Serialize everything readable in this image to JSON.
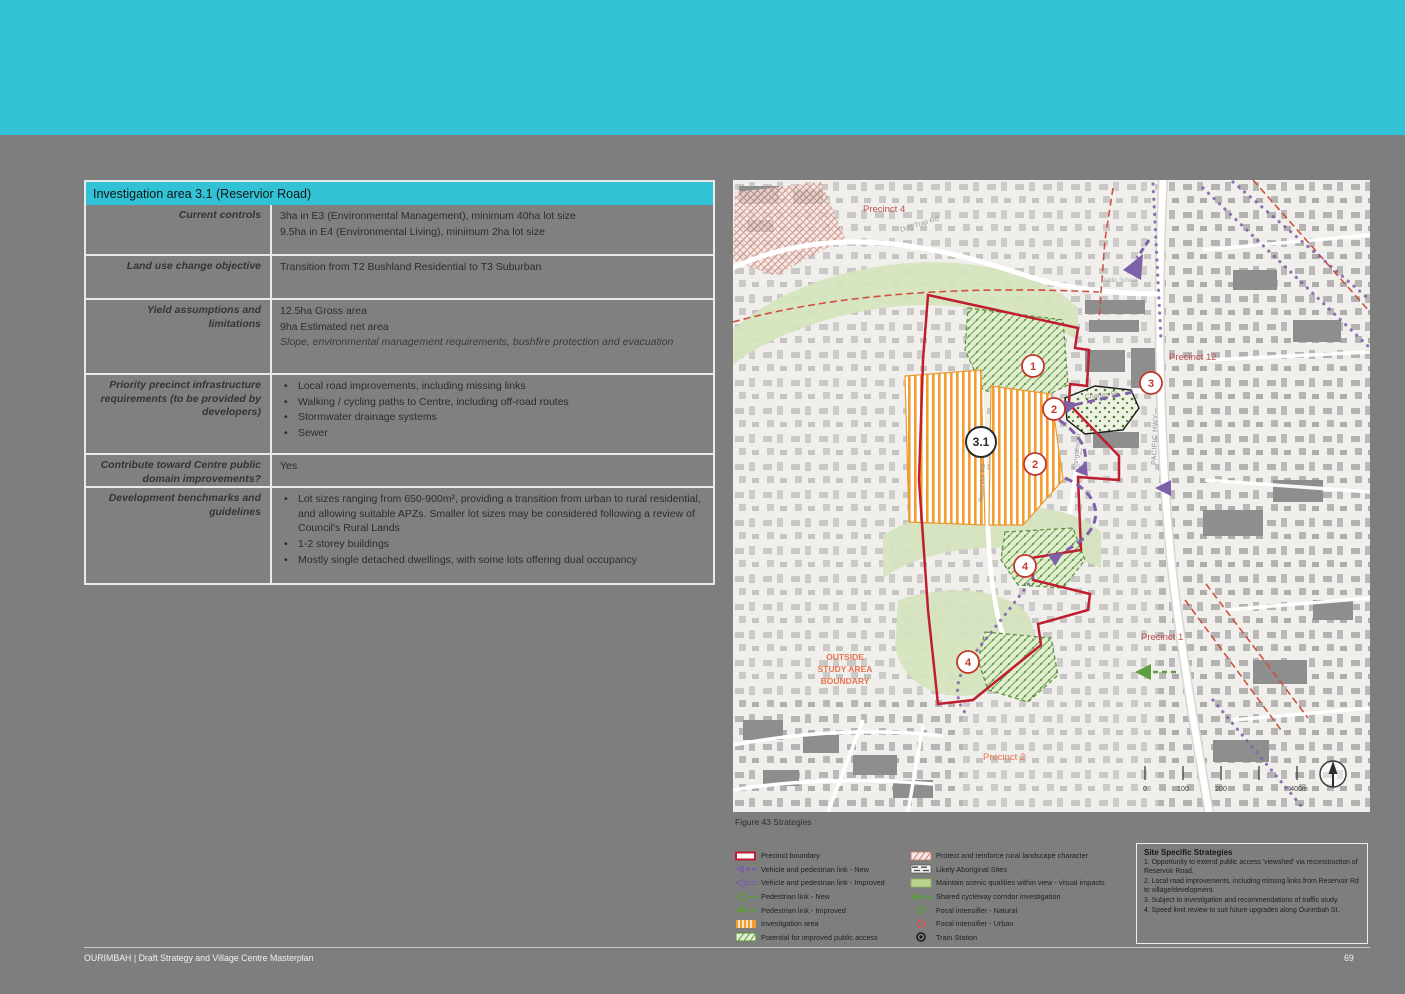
{
  "colors": {
    "banner": "#31c3d5",
    "page_bg": "#7e7e7e",
    "precinct_red": "#bf1e2e",
    "link_purple": "#7d60a8",
    "link_green": "#5f9e3e",
    "investigation_orange": "#f39c2f",
    "precinct_label_red": "#c0504d",
    "outside_orange": "#e8744f"
  },
  "table": {
    "title": "Investigation area 3.1 (Reservior Road)",
    "rows": [
      {
        "label": "Current controls",
        "lines": [
          "3ha in E3 (Environmental Management), minimum 40ha lot size",
          "9.5ha in E4 (Environmental Living), minimum 2ha lot size"
        ]
      },
      {
        "label": "Land use change objective",
        "lines": [
          "Transition from T2 Bushland Residential to T3 Suburban"
        ]
      },
      {
        "label": "Yield assumptions and limitations",
        "lines": [
          "12.5ha Gross area",
          "9ha Estimated net area"
        ],
        "note": "Slope, environmental management requirements, bushfire protection and evacuation"
      },
      {
        "label": "Priority precinct infrastructure requirements (to be provided by developers)",
        "bullets": [
          "Local road improvements, including missing links",
          "Walking / cycling paths to Centre, including off-road routes",
          "Stormwater drainage systems",
          "Sewer"
        ]
      },
      {
        "label": "Contribute toward Centre public domain improvements?",
        "lines": [
          "Yes"
        ]
      },
      {
        "label": "Development benchmarks and guidelines",
        "bullets": [
          "Lot sizes ranging from 650-900m², providing a transition from urban to rural residential, and allowing suitable APZs. Smaller lot sizes may be considered following a review of Council's Rural Lands",
          "1-2 storey buildings",
          "Mostly single detached dwellings, with some lots offering dual occupancy"
        ]
      }
    ]
  },
  "map": {
    "caption": "Figure 43 Strategies",
    "labels": {
      "precinct4": "Precinct 4",
      "precinct12": "Precinct 12",
      "precinct1": "Precinct 1",
      "precinct2": "Precinct 2",
      "outside1": "OUTSIDE",
      "outside2": "STUDY AREA",
      "outside3": "BOUNDARY",
      "dog_trap": "Dog Trap Rd",
      "charles": "Charles St",
      "pacific": "PACIFIC HWY",
      "bangalow": "Bangalow St",
      "reservoir": "Reservior Rd",
      "school": "Public School"
    },
    "markers": {
      "m1": "1",
      "m2a": "2",
      "m2b": "2",
      "m3": "3",
      "m4a": "4",
      "m4b": "4",
      "m31": "3.1"
    },
    "scale": {
      "t0": "0",
      "t100": "100",
      "t200": "200",
      "t400": "400m"
    }
  },
  "legend": {
    "left": [
      {
        "label": "Precinct boundary"
      },
      {
        "label": "Vehicle and pedestrian link - New"
      },
      {
        "label": "Vehicle and pedestrian link - Improved"
      },
      {
        "label": "Pedestrian link - New"
      },
      {
        "label": "Pedestrian link - Improved"
      },
      {
        "label": "Investigation area"
      },
      {
        "label": "Potential for improved public access"
      }
    ],
    "right": [
      {
        "label": "Protect and reinforce rural landscape character"
      },
      {
        "label": "Likely Aboriginal Sites"
      },
      {
        "label": "Maintain scenic qualities within view - visual impacts"
      },
      {
        "label": "Shared cycleway corridor investigation"
      },
      {
        "label": "Focal intensifier - Natural"
      },
      {
        "label": "Focal intensifier - Urban"
      },
      {
        "label": "Train Station"
      }
    ]
  },
  "strategies": {
    "title": "Site Specific Strategies",
    "items": [
      "1. Opportunity to extend public access 'viewshed' via reconstruction of Reservoir Road.",
      "2. Local road improvements, including missing links from Reservoir Rd to village/development.",
      "3. Subject to investigation and recommendations of traffic study.",
      "4. Speed limit review to suit future upgrades along Ourimbah St."
    ]
  },
  "footer": {
    "left": "OURIMBAH | Draft Strategy and Village Centre Masterplan",
    "page": "69"
  }
}
